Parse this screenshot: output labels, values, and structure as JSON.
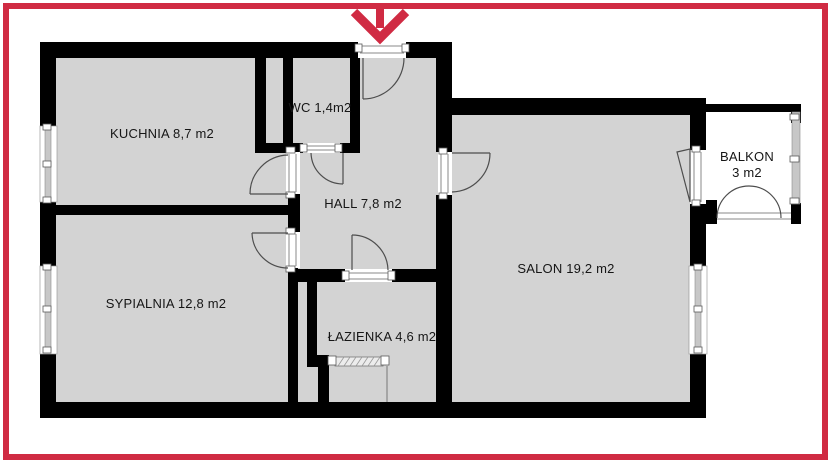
{
  "floor_plan": {
    "rooms": [
      {
        "id": "kuchnia",
        "label": "KUCHNIA 8,7 m2"
      },
      {
        "id": "wc",
        "label": "WC 1,4m2"
      },
      {
        "id": "hall",
        "label": "HALL 7,8 m2"
      },
      {
        "id": "sypialnia",
        "label": "SYPIALNIA 12,8 m2"
      },
      {
        "id": "lazienka",
        "label": "ŁAZIENKA 4,6 m2"
      },
      {
        "id": "salon",
        "label": "SALON 19,2 m2"
      },
      {
        "id": "balkon",
        "label": "BALKON",
        "area": "3 m2"
      }
    ],
    "colors": {
      "highlight_red": "#d02b43",
      "wall": "#000000",
      "room_fill": "#d3d3d3",
      "background": "#ffffff"
    }
  }
}
